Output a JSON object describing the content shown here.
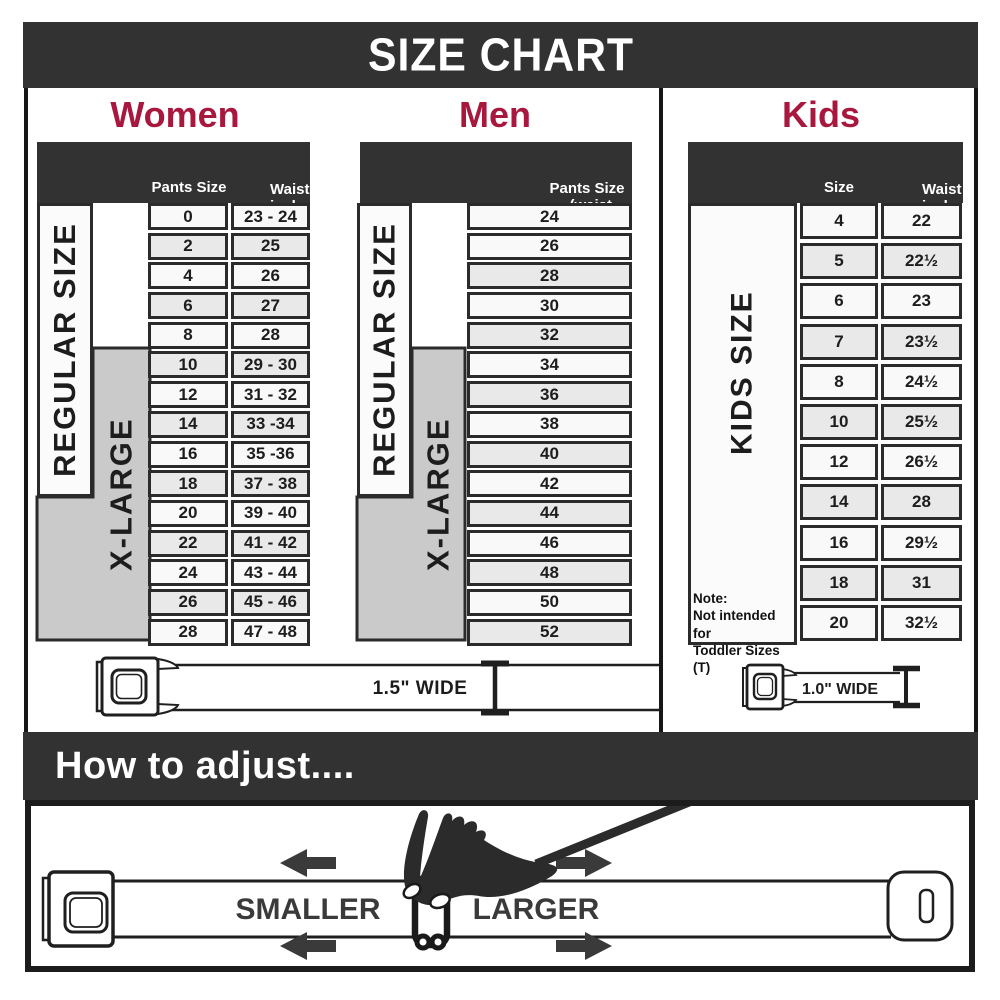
{
  "title": "SIZE CHART",
  "colors": {
    "accent": "#a8173d",
    "dark": "#323232"
  },
  "sections": {
    "women": {
      "title": "Women",
      "col1_header": "Pants Size",
      "col2_header_line1": "Waist",
      "col2_header_line2": "inches",
      "regular_label": "REGULAR SIZE",
      "xlarge_label": "X-LARGE",
      "rows": [
        {
          "size": "0",
          "waist": "23 - 24"
        },
        {
          "size": "2",
          "waist": "25"
        },
        {
          "size": "4",
          "waist": "26"
        },
        {
          "size": "6",
          "waist": "27"
        },
        {
          "size": "8",
          "waist": "28"
        },
        {
          "size": "10",
          "waist": "29 - 30"
        },
        {
          "size": "12",
          "waist": "31 - 32"
        },
        {
          "size": "14",
          "waist": "33 -34"
        },
        {
          "size": "16",
          "waist": "35 -36"
        },
        {
          "size": "18",
          "waist": "37 - 38"
        },
        {
          "size": "20",
          "waist": "39 - 40"
        },
        {
          "size": "22",
          "waist": "41 - 42"
        },
        {
          "size": "24",
          "waist": "43 - 44"
        },
        {
          "size": "26",
          "waist": "45 - 46"
        },
        {
          "size": "28",
          "waist": "47 - 48"
        }
      ]
    },
    "men": {
      "title": "Men",
      "header_line1": "Pants Size",
      "header_line2": "(waist inches)",
      "regular_label": "REGULAR SIZE",
      "xlarge_label": "X-LARGE",
      "rows": [
        "24",
        "26",
        "28",
        "30",
        "32",
        "34",
        "36",
        "38",
        "40",
        "42",
        "44",
        "46",
        "48",
        "50",
        "52"
      ]
    },
    "kids": {
      "title": "Kids",
      "col1_header": "Size",
      "col2_header_line1": "Waist",
      "col2_header_line2": "inches",
      "side_label": "KIDS SIZE",
      "note_lines": [
        "Note:",
        "Not intended for",
        "Toddler Sizes (T)"
      ],
      "rows": [
        {
          "size": "4",
          "waist": "22"
        },
        {
          "size": "5",
          "waist": "22½"
        },
        {
          "size": "6",
          "waist": "23"
        },
        {
          "size": "7",
          "waist": "23½"
        },
        {
          "size": "8",
          "waist": "24½"
        },
        {
          "size": "10",
          "waist": "25½"
        },
        {
          "size": "12",
          "waist": "26½"
        },
        {
          "size": "14",
          "waist": "28"
        },
        {
          "size": "16",
          "waist": "29½"
        },
        {
          "size": "18",
          "waist": "31"
        },
        {
          "size": "20",
          "waist": "32½"
        }
      ]
    }
  },
  "belts": {
    "adult_width_label": "1.5\" WIDE",
    "kids_width_label": "1.0\" WIDE"
  },
  "how_to": {
    "title": "How to adjust....",
    "smaller_label": "SMALLER",
    "larger_label": "LARGER"
  }
}
